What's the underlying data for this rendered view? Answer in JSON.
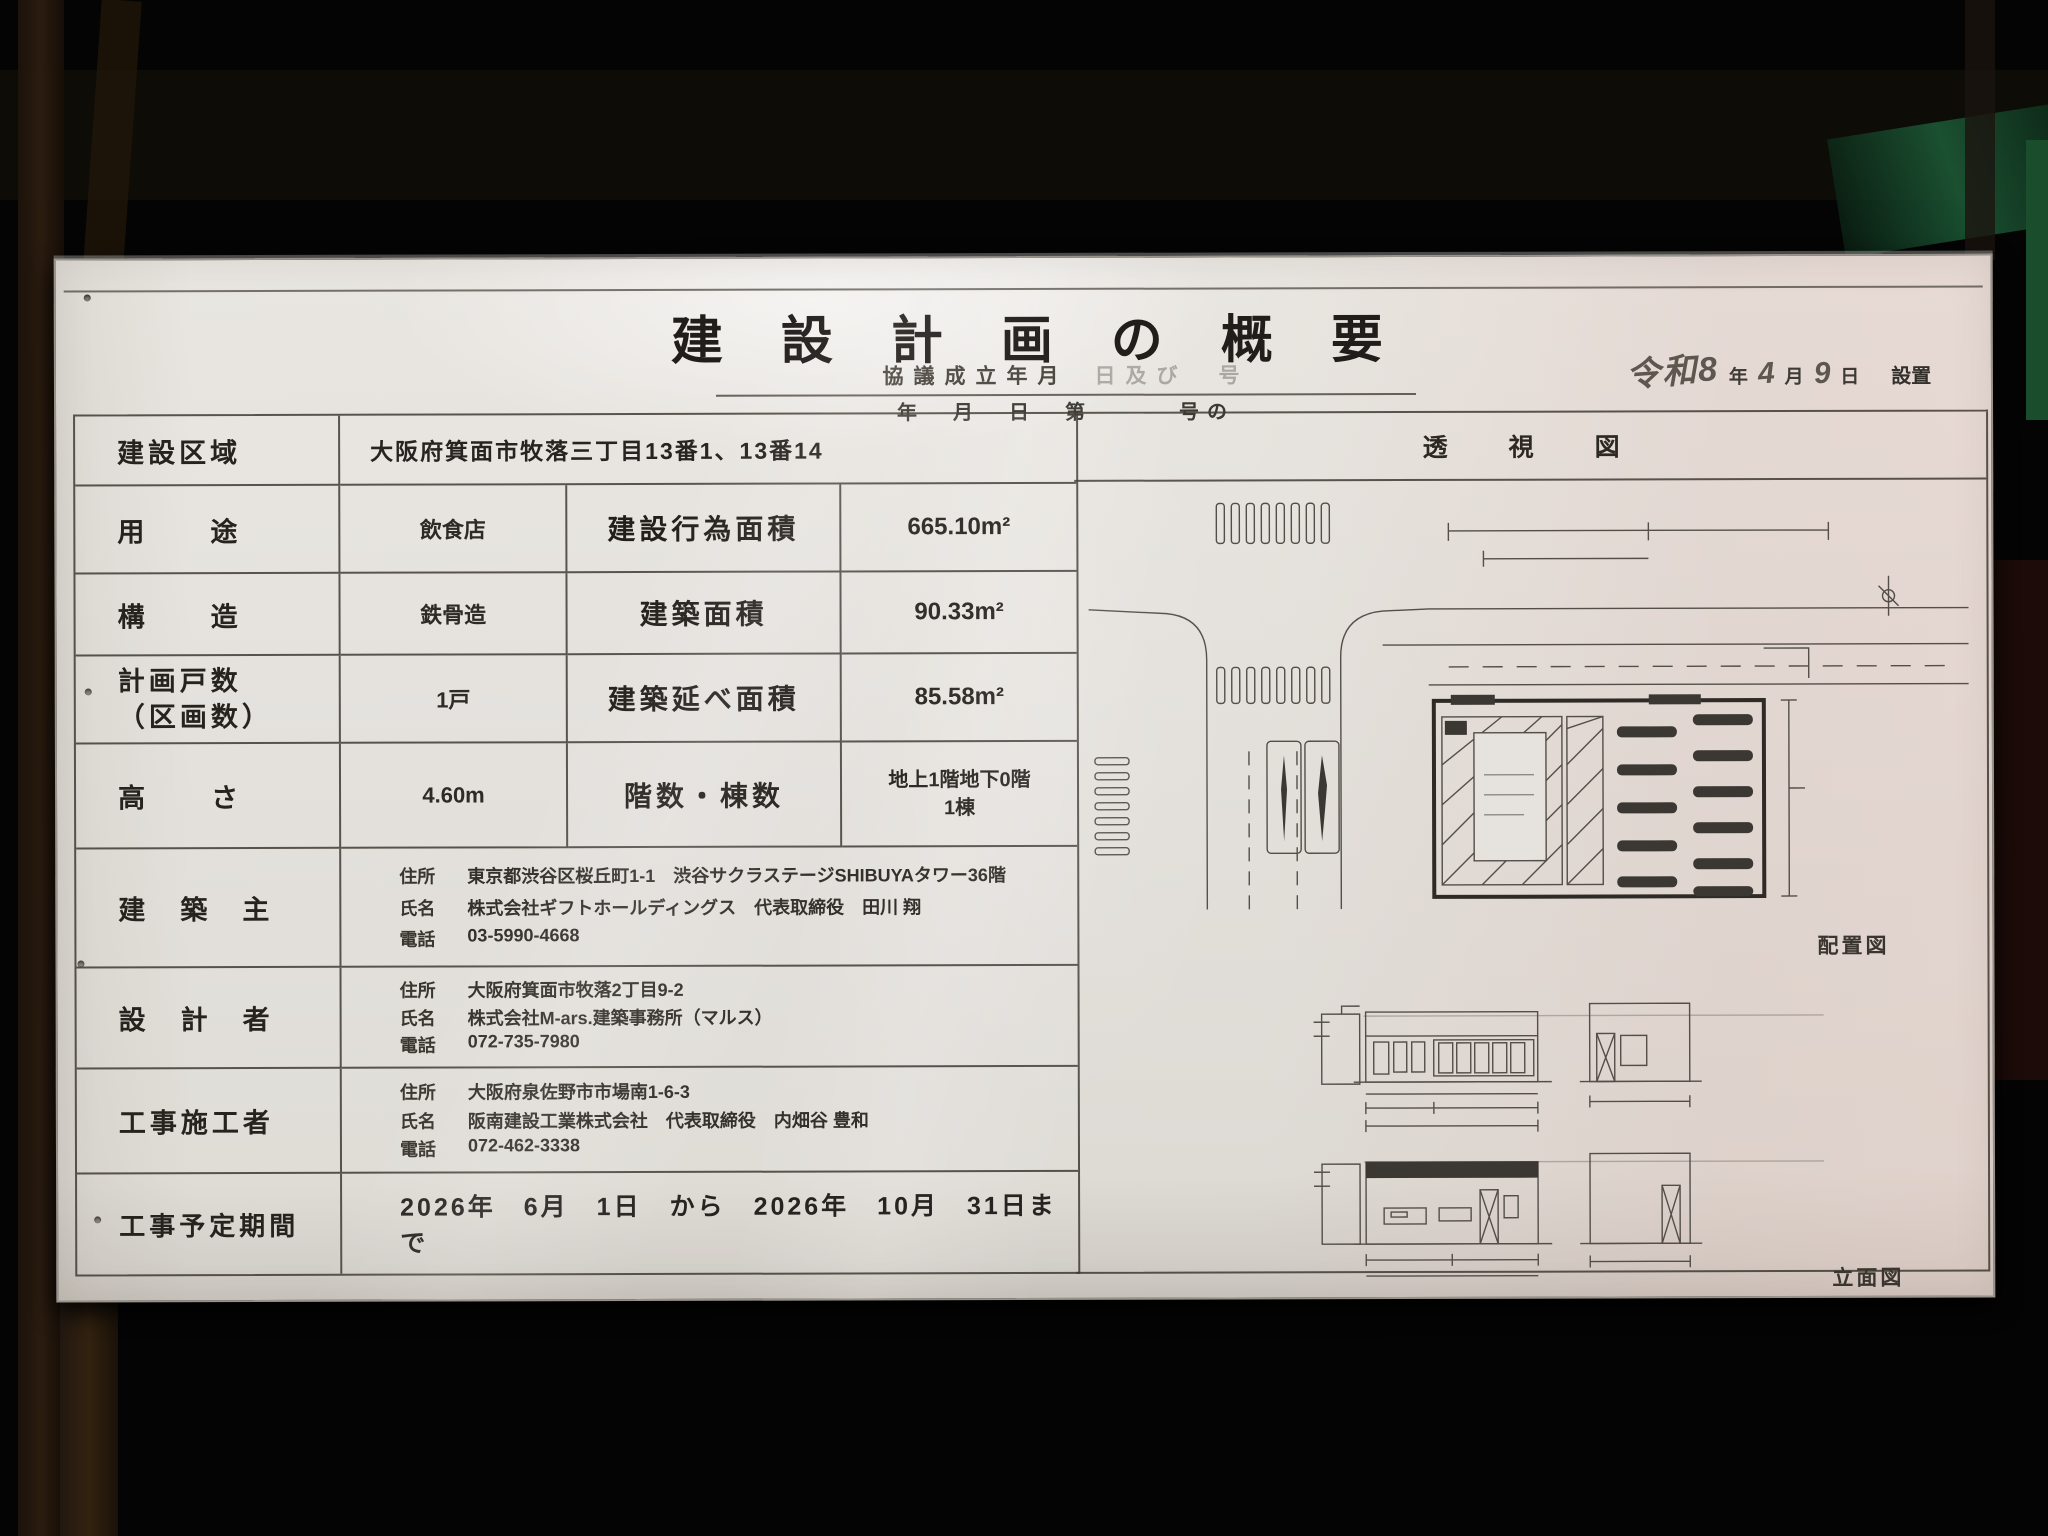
{
  "colors": {
    "board": "#e6e3de",
    "grid_line": "#3e3932",
    "ink": "#2b2824",
    "handwriting": "#5d5750"
  },
  "header": {
    "title": "建設計画の概要",
    "subtitle_left": "協議成立年月",
    "subtitle_right": "日及び　号",
    "line2_left": "年　月　日　第",
    "line2_right": "号の",
    "install": {
      "era_year": "令和8",
      "year_unit": "年",
      "month": "4",
      "month_unit": "月",
      "day": "9",
      "day_unit": "日",
      "suffix": "設置"
    }
  },
  "table": {
    "construction_area": {
      "label": "建設区域",
      "value": "大阪府箕面市牧落三丁目13番1、13番14"
    },
    "usage": {
      "label": "用　　途",
      "value": "飲食店"
    },
    "construction_act_area": {
      "label": "建設行為面積",
      "value": "665.10m²"
    },
    "structure": {
      "label": "構　　造",
      "value": "鉄骨造"
    },
    "building_area": {
      "label": "建築面積",
      "value": "90.33m²"
    },
    "planned_units": {
      "label_line1": "計画戸数",
      "label_line2": "（区画数）",
      "value": "1戸"
    },
    "total_floor_area": {
      "label": "建築延べ面積",
      "value": "85.58m²"
    },
    "height": {
      "label": "高　　さ",
      "value": "4.60m"
    },
    "floors": {
      "label": "階数・棟数",
      "value_line1": "地上1階地下0階",
      "value_line2": "1棟"
    },
    "owner": {
      "label": "建　築　主",
      "address_label": "住所",
      "address": "東京都渋谷区桜丘町1-1　渋谷サクラステージSHIBUYAタワー36階",
      "name_label": "氏名",
      "name": "株式会社ギフトホールディングス　代表取締役　田川 翔",
      "tel_label": "電話",
      "tel": "03-5990-4668"
    },
    "designer": {
      "label": "設　計　者",
      "address_label": "住所",
      "address": "大阪府箕面市牧落2丁目9-2",
      "name_label": "氏名",
      "name": "株式会社M-ars.建築事務所（マルス）",
      "tel_label": "電話",
      "tel": "072-735-7980"
    },
    "contractor": {
      "label": "工事施工者",
      "address_label": "住所",
      "address": "大阪府泉佐野市市場南1-6-3",
      "name_label": "氏名",
      "name": "阪南建設工業株式会社　代表取締役　内畑谷 豊和",
      "tel_label": "電話",
      "tel": "072-462-3338"
    },
    "period": {
      "label": "工事予定期間",
      "value": "2026年　6月　1日　から　2026年　10月　31日まで"
    }
  },
  "drawings": {
    "perspective_label": "透　視　図",
    "site_plan_label": "配置図",
    "elevation_label": "立面図"
  }
}
